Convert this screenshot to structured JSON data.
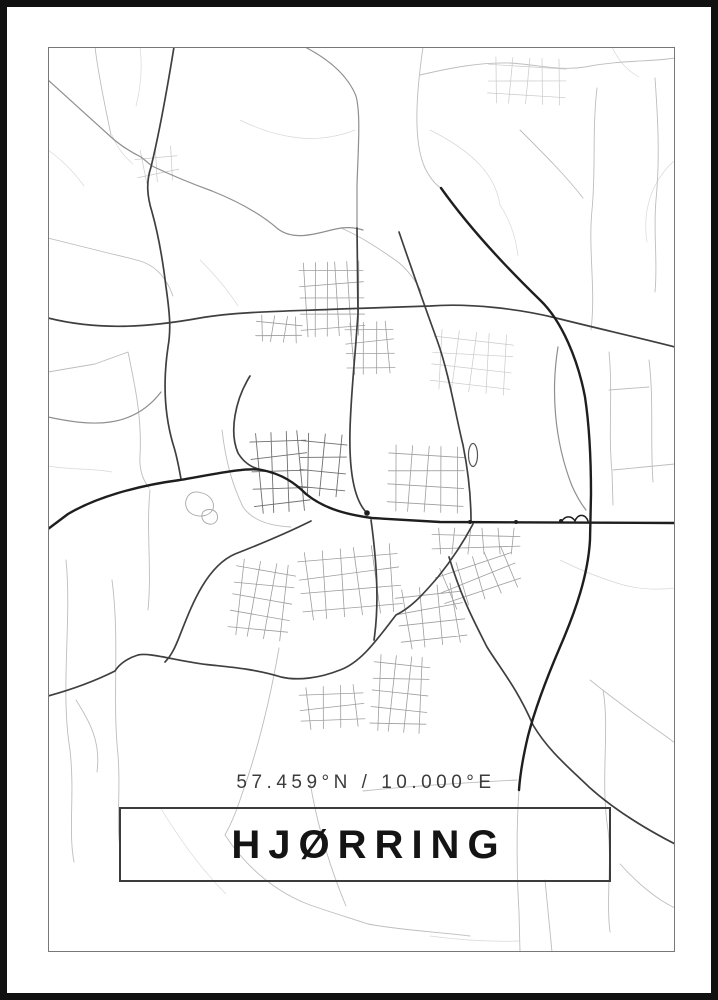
{
  "poster": {
    "coordinates": "57.459°N / 10.000°E",
    "title": "HJØRRING",
    "colors": {
      "outer_border": "#111111",
      "frame_line": "#787878",
      "box_border": "#3c3c3c",
      "title_text": "#141414",
      "coords_text": "#3c3c3c",
      "road_faint": "#d8d8d8",
      "road_light": "#bdbdbd",
      "road_grid": "#9e9e9e",
      "road_grid_light": "#c9c9c9",
      "road_grid_dark": "#6f6f6f",
      "road_medium": "#8f8f8f",
      "road_dark": "#3f3f3f",
      "road_darkest": "#1e1e1e",
      "pond_stroke": "#a8a8a8",
      "background": "#ffffff"
    }
  },
  "map": {
    "viewBox": "48 47 627 905",
    "road_layers": [
      {
        "class": "road-faint",
        "paths": [
          "M112,135 C118,150 126,158 133,164",
          "M612,47 C618,60 626,70 639,77",
          "M675,160 C652,180 642,210 647,242",
          "M160,807 C180,840 202,870 226,894",
          "M140,47 C143,70 140,90 136,106",
          "M48,150 C62,160 74,172 84,186",
          "M240,120 C260,130 280,136 300,138 C320,140 340,136 355,130",
          "M200,260 C215,275 228,290 238,306",
          "M48,466 C70,470 92,468 112,472",
          "M430,936 C460,940 490,942 519,941",
          "M560,560 C580,570 600,578 620,584 C640,590 658,590 675,588",
          "M430,130 C450,140 468,152 480,165 C492,178 498,192 500,205",
          "M500,205 C510,220 516,238 518,256"
        ]
      },
      {
        "class": "road-light",
        "paths": [
          "M423,47 C416,95 413,142 425,168 C430,178 436,185 441,188",
          "M519,790 C516,830 517,880 519,912 L520,952",
          "M420,75 C450,68 480,62 510,63 C540,65 560,71 585,67 C620,60 650,62 675,58",
          "M597,88 C592,130 596,170 592,210 C588,250 596,290 591,330",
          "M655,78 C658,120 660,160 656,200 C653,232 658,262 655,292",
          "M520,130 C545,155 566,176 583,198",
          "M609,352 C613,392 608,432 612,472 L613,505",
          "M649,360 C654,400 650,440 653,482",
          "M609,390 L649,387",
          "M613,470 L675,464",
          "M95,47 C99,80 106,110 111,135",
          "M48,238 L96,250 C115,255 131,258 143,262 C159,268 168,282 173,296",
          "M48,372 L95,364 L128,352 C136,390 142,420 140,456 C139,470 143,480 149,488",
          "M66,560 C72,620 60,690 70,750 C75,795 68,830 74,862",
          "M112,580 C120,640 112,700 118,755 C121,790 116,820 120,848",
          "M76,700 C90,722 101,742 97,772",
          "M222,430 C226,464 233,486 243,507 C252,520 270,526 291,527",
          "M279,648 C270,700 258,750 240,800 C235,815 230,826 225,835",
          "M225,835 C248,870 278,893 310,905 C330,912 350,918 368,924",
          "M310,782 C318,830 331,870 346,906",
          "M368,924 C400,930 438,932 470,936",
          "M603,690 C610,730 600,780 608,830 C612,862 606,900 610,932",
          "M545,880 C548,910 550,932 552,952",
          "M620,864 C640,886 658,900 675,908",
          "M590,680 C615,700 641,719 667,737 L675,743",
          "M341,228 C362,237 381,250 398,262 C408,270 415,280 421,291",
          "M363,791 C400,787 460,783 517,780",
          "M150,490 C146,530 152,570 148,610"
        ]
      },
      {
        "class": "road-medium",
        "paths": [
          "M48,80 C70,100 90,118 111,137 C122,147 133,153 141,157 L152,166",
          "M152,166 C175,177 190,183 212,191 C242,203 262,215 278,229 C297,243 322,231 341,228 C350,227 357,228 363,230",
          "M558,347 C551,390 554,440 572,486 C577,497 582,505 586,510",
          "M305,47 C330,60 348,76 356,96 C361,115 358,150 357,186 L357,228",
          "M48,417 C90,426 132,430 161,392"
        ]
      },
      {
        "class": "road-dark",
        "paths": [
          "M174,47 C167,90 160,130 151,167 C146,182 147,196 152,212 C159,237 163,262 166,287 C170,315 171,330 168,347 C162,388 166,420 173,444 C177,456 179,468 181,479",
          "M48,318 C100,331 150,327 200,318 C240,311 300,311 340,309 L430,306 C470,303 520,309 556,318 C600,329 640,338 675,347",
          "M399,232 C412,270 421,296 437,340 C449,373 456,417 463,445 C468,470 471,498 471,521",
          "M357,228 L358,313 C355,360 351,392 350,430 C349,470 354,499 366,512",
          "M250,376 C235,400 229,432 238,453 C244,463 252,468 262,470",
          "M473,524 C462,545 450,562 438,577 C420,598 410,608 396,615 C378,638 362,662 340,670 C320,678 298,681 281,677 C255,669 230,667 211,665 C180,662 150,652 138,655 C125,659 118,666 115,671 C95,681 70,690 48,696",
          "M449,557 C462,600 476,625 487,647 C500,668 517,688 533,725 C548,750 566,765 589,787 C610,806 640,826 675,844",
          "M371,520 C376,556 380,600 374,640",
          "M311,521 C285,534 258,545 235,554 C205,567 190,610 180,635 C175,648 171,656 165,662"
        ]
      },
      {
        "class": "road-darkest",
        "paths": [
          "M48,529 L68,514 C95,498 135,486 180,480 C215,474 246,467 262,470 C282,474 295,483 306,494 C322,507 342,514 372,518 L440,522 L675,523",
          "M441,188 C468,226 506,267 540,300 C562,321 578,360 585,397 C590,430 591,470 591,494 L590,540 C588,575 576,610 560,647 C548,675 536,705 528,736 C523,757 520,775 519,790"
        ]
      }
    ],
    "grids": [
      {
        "x": 300,
        "y": 262,
        "w": 64,
        "h": 74,
        "rows": 5,
        "cols": 6,
        "angle": -2,
        "class": "road-grid"
      },
      {
        "x": 256,
        "y": 316,
        "w": 46,
        "h": 26,
        "rows": 2,
        "cols": 4,
        "angle": 3,
        "class": "road-grid"
      },
      {
        "x": 346,
        "y": 322,
        "w": 48,
        "h": 52,
        "rows": 4,
        "cols": 4,
        "angle": -3,
        "class": "road-grid"
      },
      {
        "x": 432,
        "y": 332,
        "w": 80,
        "h": 60,
        "rows": 4,
        "cols": 5,
        "angle": 5,
        "class": "road-grid-light"
      },
      {
        "x": 388,
        "y": 446,
        "w": 76,
        "h": 66,
        "rows": 4,
        "cols": 5,
        "angle": 2,
        "class": "road-grid"
      },
      {
        "x": 252,
        "y": 432,
        "w": 56,
        "h": 80,
        "rows": 5,
        "cols": 4,
        "angle": -4,
        "class": "road-grid-dark"
      },
      {
        "x": 300,
        "y": 434,
        "w": 46,
        "h": 62,
        "rows": 4,
        "cols": 3,
        "angle": 3,
        "class": "road-grid-dark"
      },
      {
        "x": 300,
        "y": 548,
        "w": 100,
        "h": 68,
        "rows": 4,
        "cols": 6,
        "angle": -6,
        "class": "road-grid"
      },
      {
        "x": 232,
        "y": 562,
        "w": 60,
        "h": 76,
        "rows": 5,
        "cols": 4,
        "angle": 8,
        "class": "road-grid"
      },
      {
        "x": 372,
        "y": 656,
        "w": 56,
        "h": 76,
        "rows": 5,
        "cols": 4,
        "angle": 4,
        "class": "road-grid"
      },
      {
        "x": 136,
        "y": 148,
        "w": 42,
        "h": 34,
        "rows": 2,
        "cols": 3,
        "angle": -8,
        "class": "road-grid-light"
      },
      {
        "x": 488,
        "y": 58,
        "w": 78,
        "h": 46,
        "rows": 3,
        "cols": 5,
        "angle": 2,
        "class": "road-grid-light"
      },
      {
        "x": 432,
        "y": 528,
        "w": 88,
        "h": 26,
        "rows": 2,
        "cols": 6,
        "angle": 0,
        "class": "road-grid"
      },
      {
        "x": 300,
        "y": 686,
        "w": 64,
        "h": 42,
        "rows": 3,
        "cols": 4,
        "angle": -4,
        "class": "road-grid"
      },
      {
        "x": 438,
        "y": 556,
        "w": 80,
        "h": 44,
        "rows": 3,
        "cols": 5,
        "angle": -20,
        "class": "road-grid"
      },
      {
        "x": 398,
        "y": 586,
        "w": 66,
        "h": 60,
        "rows": 4,
        "cols": 4,
        "angle": -8,
        "class": "road-grid"
      }
    ],
    "ponds": [
      "M188,496 C184,502 185,510 192,514 C200,518 210,516 213,509 C215,502 210,495 202,493 C196,491 191,492 188,496 Z",
      "M203,512 C200,517 203,523 209,524 C215,525 219,520 217,514 C215,509 207,508 203,512 Z"
    ],
    "stadium": {
      "cx": 473,
      "cy": 455,
      "rx": 4.5,
      "ry": 11.5
    },
    "ramps": "M562,521 a8,10 0 0 1 13,0 a7,9 0 0 1 13,0",
    "junctions": [
      {
        "cx": 470,
        "cy": 522,
        "r": 2
      },
      {
        "cx": 516,
        "cy": 522,
        "r": 2
      },
      {
        "cx": 561,
        "cy": 521,
        "r": 2
      },
      {
        "cx": 367,
        "cy": 513,
        "r": 2.8
      }
    ]
  }
}
